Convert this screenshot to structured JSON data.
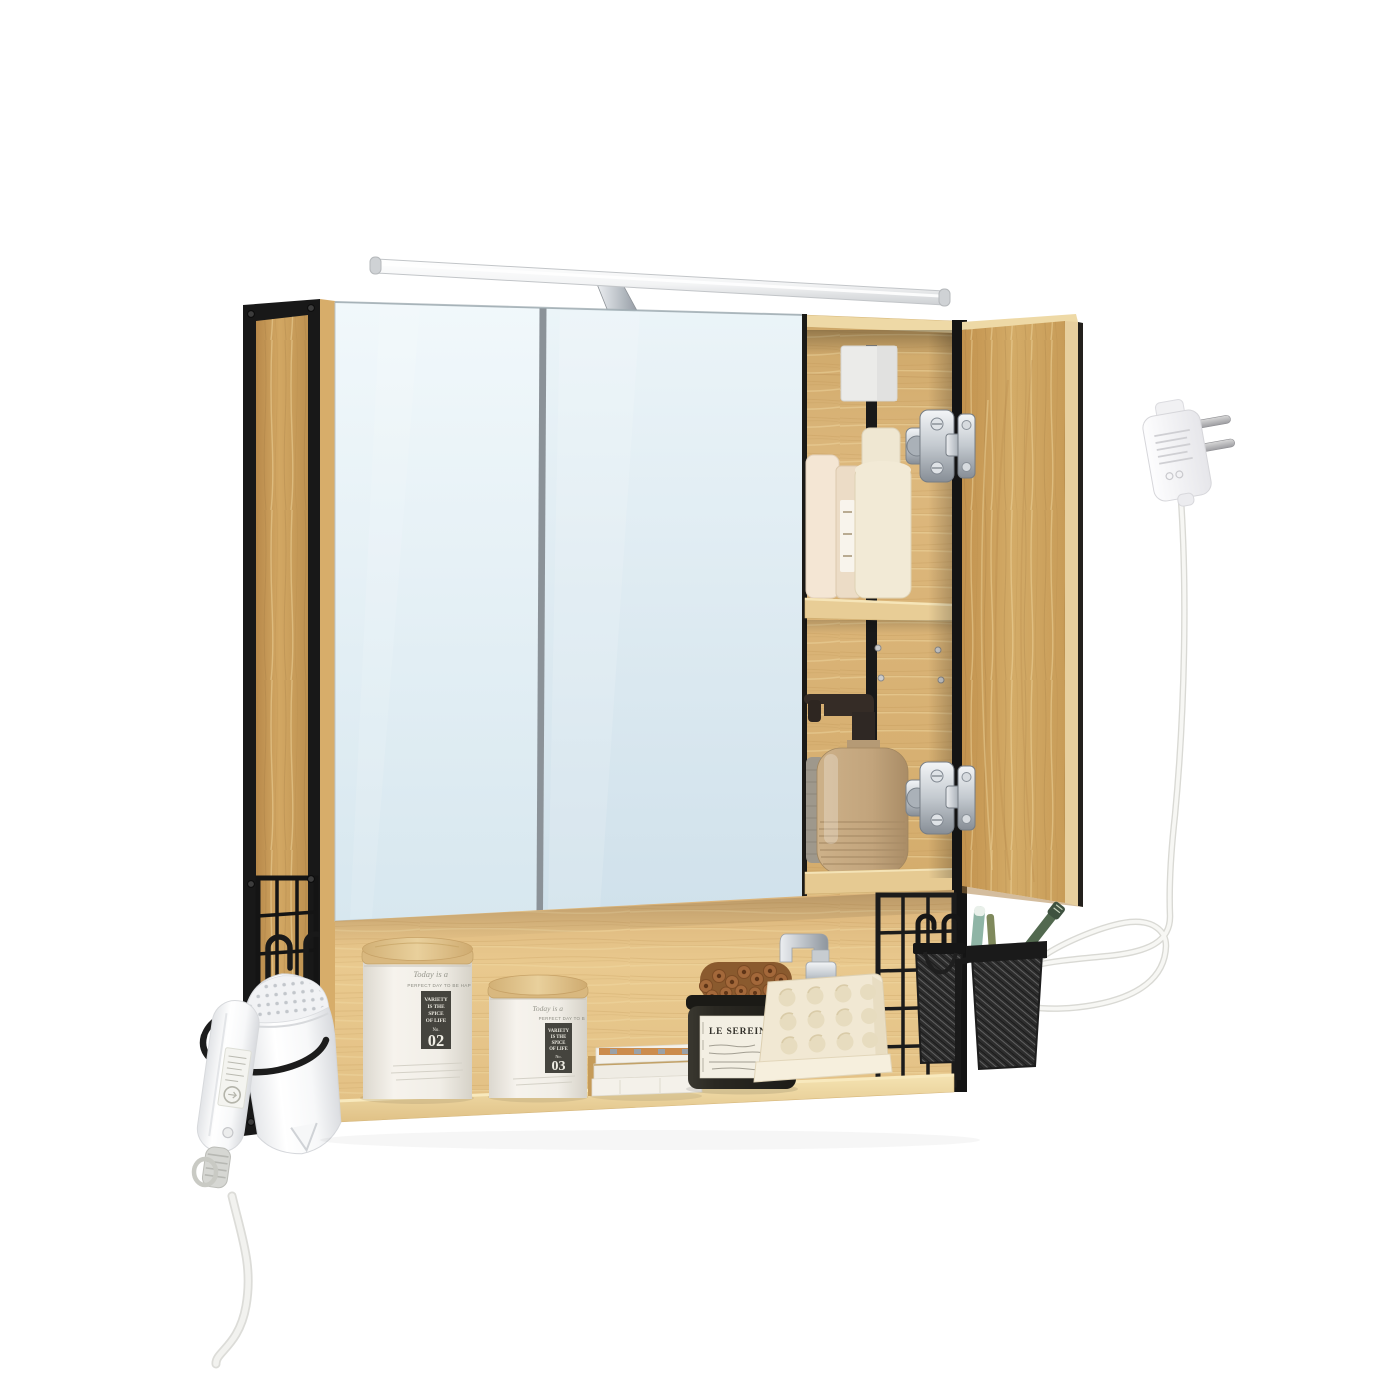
{
  "product": {
    "name": "Wall-mounted bathroom mirror cabinet with LED light, oak finish, black steel frame, open shelf",
    "scene": "studio product photo on white background"
  },
  "palette": {
    "background": "#ffffff",
    "oak": "#d0a261",
    "oak_light": "#ecd4a0",
    "frame_black": "#1a1a1a",
    "mirror_tint": "#dfeef5",
    "chrome": "#c5cad0",
    "label_plate": "#45443e",
    "stone_beige": "#c3a57e",
    "jar_black": "#26241f"
  },
  "canister_large": {
    "script": "Today is a",
    "tagline": "PERFECT DAY TO BE HAP",
    "plate_lines": [
      "VARIETY",
      "IS THE",
      "SPICE",
      "OF LIFE"
    ],
    "no_prefix": "No.",
    "number": "02"
  },
  "canister_small": {
    "script": "Today is a",
    "tagline": "PERFECT DAY TO B",
    "plate_lines": [
      "VARIETY",
      "IS THE",
      "SPICE",
      "OF LIFE"
    ],
    "no_prefix": "No.",
    "number": "03"
  },
  "black_jar": {
    "brand": "LE SEREIN LAB"
  }
}
